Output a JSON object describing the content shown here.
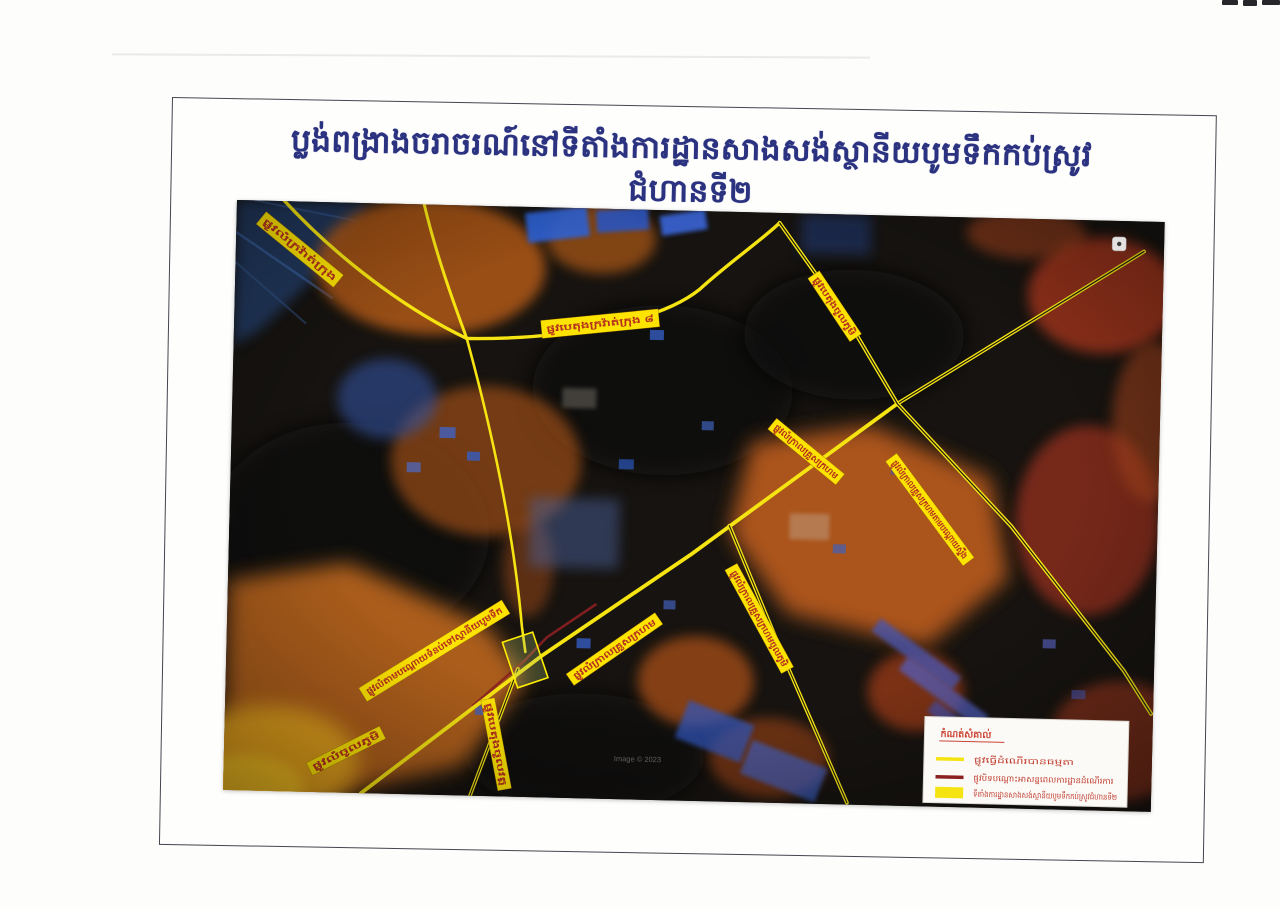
{
  "page": {
    "title": "ប្លង់ពង្រាងចរាចរណ៍នៅទីតាំងការដ្ឋានសាងសង់ស្ថានីយបូមទឹកកប់ស្រូវ ជំហានទី២"
  },
  "map": {
    "road_labels": [
      {
        "text": "ផ្លូវលំក្រវ៉ាត់ក្រុង"
      },
      {
        "text": "ផ្លូវបេតុងក្រវ៉ាត់ក្រុង ៨"
      },
      {
        "text": "ផ្លូវបេតុងចូលភូមិ"
      },
      {
        "text": "ផ្លូវលំក្រាលគ្រួសក្រហម"
      },
      {
        "text": "ផ្លូវលំក្រាលគ្រួសក្រហមតាមបណ្ដោយស្ទឹង"
      },
      {
        "text": "ផ្លូវលំក្រាលគ្រួសក្រហមចូលភូមិ"
      },
      {
        "text": "ផ្លូវលំតាមបណ្ដោយទំនប់ទៅស្ថានីយបូមទឹក"
      },
      {
        "text": "ផ្លូវលំក្រាលគ្រួសក្រហម"
      },
      {
        "text": "ផ្លូវបេតុងចូលវត្ត"
      },
      {
        "text": "ផ្លូវលំចូលភូមិ"
      }
    ],
    "legend": {
      "title": "កំណត់សំគាល់",
      "items": [
        {
          "swatch": "yellow-line",
          "label": "ផ្លូវធ្វើដំណើរបានធម្មតា"
        },
        {
          "swatch": "dark-red-line",
          "label": "ផ្លូវបិទបណ្ដោះអាសន្នពេលការដ្ឋានដំណើរការ"
        },
        {
          "swatch": "yellow-rect",
          "label": "ទីតាំងការដ្ឋានសាងសង់ស្ថានីយបូមទឹកកប់ស្រូវជំហានទី២"
        }
      ]
    },
    "watermark": "Image © 2023",
    "colors": {
      "road_open": "#f6e412",
      "road_closed": "#8a2020",
      "label_background": "#fde400",
      "label_text": "#b5301f",
      "title_blue": "#2b3280",
      "legend_text_red": "#c0392b"
    }
  }
}
